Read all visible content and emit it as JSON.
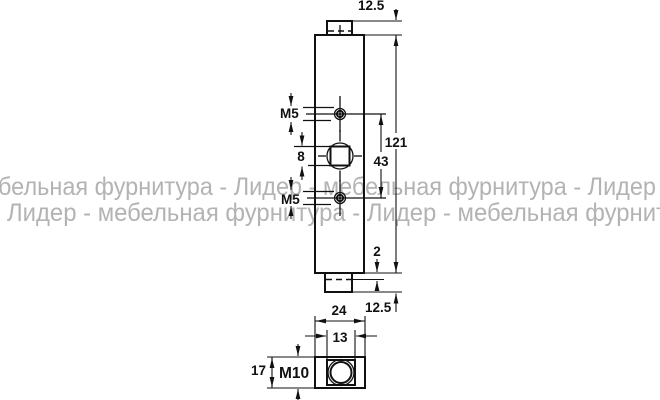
{
  "watermark": {
    "line1": "бельная фурнитура - Лидер - мебельная фурнитура - Лидер",
    "line2": "Лидер - мебельная фурнитура - Лидер - мебельная фурнит",
    "color": "#b3b3b3"
  },
  "dims": {
    "top_tab_length": "12.5",
    "total_height": "121",
    "hole_spacing": "43",
    "top_thread": "M5",
    "square_hole_width": "8",
    "bottom_thread": "M5",
    "shoulder_gap": "2",
    "bottom_tab_length": "12.5",
    "housing_width": "24",
    "neck_width": "13",
    "housing_height": "17",
    "nut_thread": "M10"
  },
  "colors": {
    "line": "#111111",
    "background": "#ffffff"
  }
}
